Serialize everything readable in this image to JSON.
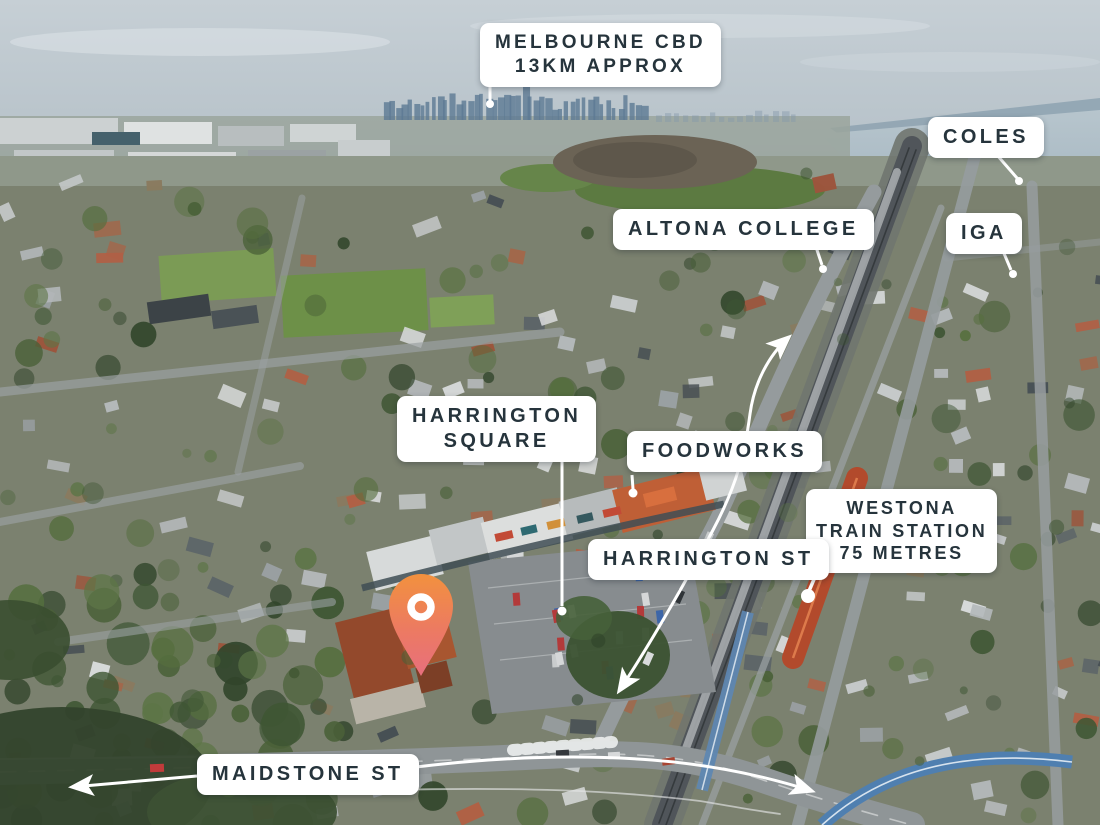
{
  "labels": {
    "melbourne_cbd": {
      "line1": "MELBOURNE CBD",
      "line2": "13KM APPROX"
    },
    "coles": {
      "line1": "COLES"
    },
    "altona_college": {
      "line1": "ALTONA COLLEGE"
    },
    "iga": {
      "line1": "IGA"
    },
    "harrington_square": {
      "line1": "HARRINGTON",
      "line2": "SQUARE"
    },
    "foodworks": {
      "line1": "FOODWORKS"
    },
    "westona_train_station": {
      "line1": "WESTONA",
      "line2": "TRAIN STATION",
      "line3": "75 METRES"
    },
    "harrington_st": {
      "line1": "HARRINGTON ST"
    },
    "maidstone_st": {
      "line1": "MAIDSTONE ST"
    }
  },
  "icons": {
    "map_pin": "location-pin-icon"
  },
  "colors": {
    "label_background": "#ffffff",
    "label_text": "#26343c",
    "annotation_lines": "#ffffff",
    "pin_gradient_top": "#f2913e",
    "pin_gradient_bottom": "#e86f7d"
  }
}
